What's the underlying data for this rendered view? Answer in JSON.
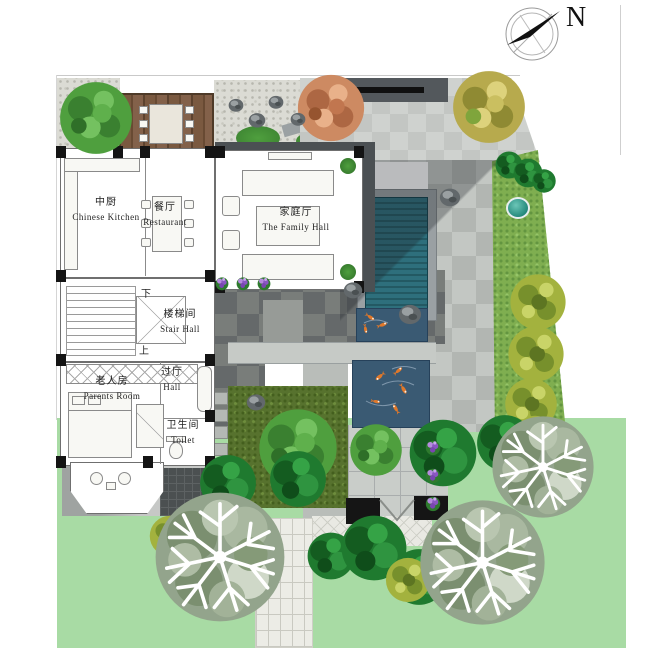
{
  "compass": {
    "label": "N"
  },
  "rooms": {
    "kitchen": {
      "cn": "中厨",
      "en": "Chinese Kitchen"
    },
    "restaurant": {
      "cn": "餐厅",
      "en": "Restaurant"
    },
    "family_hall": {
      "cn": "家庭厅",
      "en": "The Family Hall"
    },
    "stair_hall": {
      "cn": "楼梯间",
      "en": "Stair Hall"
    },
    "parents_room": {
      "cn": "老人房",
      "en": "Parents Room"
    },
    "hall": {
      "cn": "过厅",
      "en": "Hall"
    },
    "toilet": {
      "cn": "卫生间",
      "en": "Toilet"
    }
  },
  "stairs": {
    "down": "下",
    "up": "上"
  },
  "colors": {
    "lawn": "#a8dba4",
    "pool_water": "#2e6f7c",
    "pond_water": "#3a5a73",
    "deck_wood": "#7a5940",
    "moss_court": "#57722e",
    "paving_dark": "#65696a",
    "paving_light": "#c9cdc9",
    "koi_fish": "#e0782a",
    "flower_purple": "#8a56c2",
    "autumn_tree": "#cd8a62",
    "yellow_tree": "#b7aa4d"
  }
}
